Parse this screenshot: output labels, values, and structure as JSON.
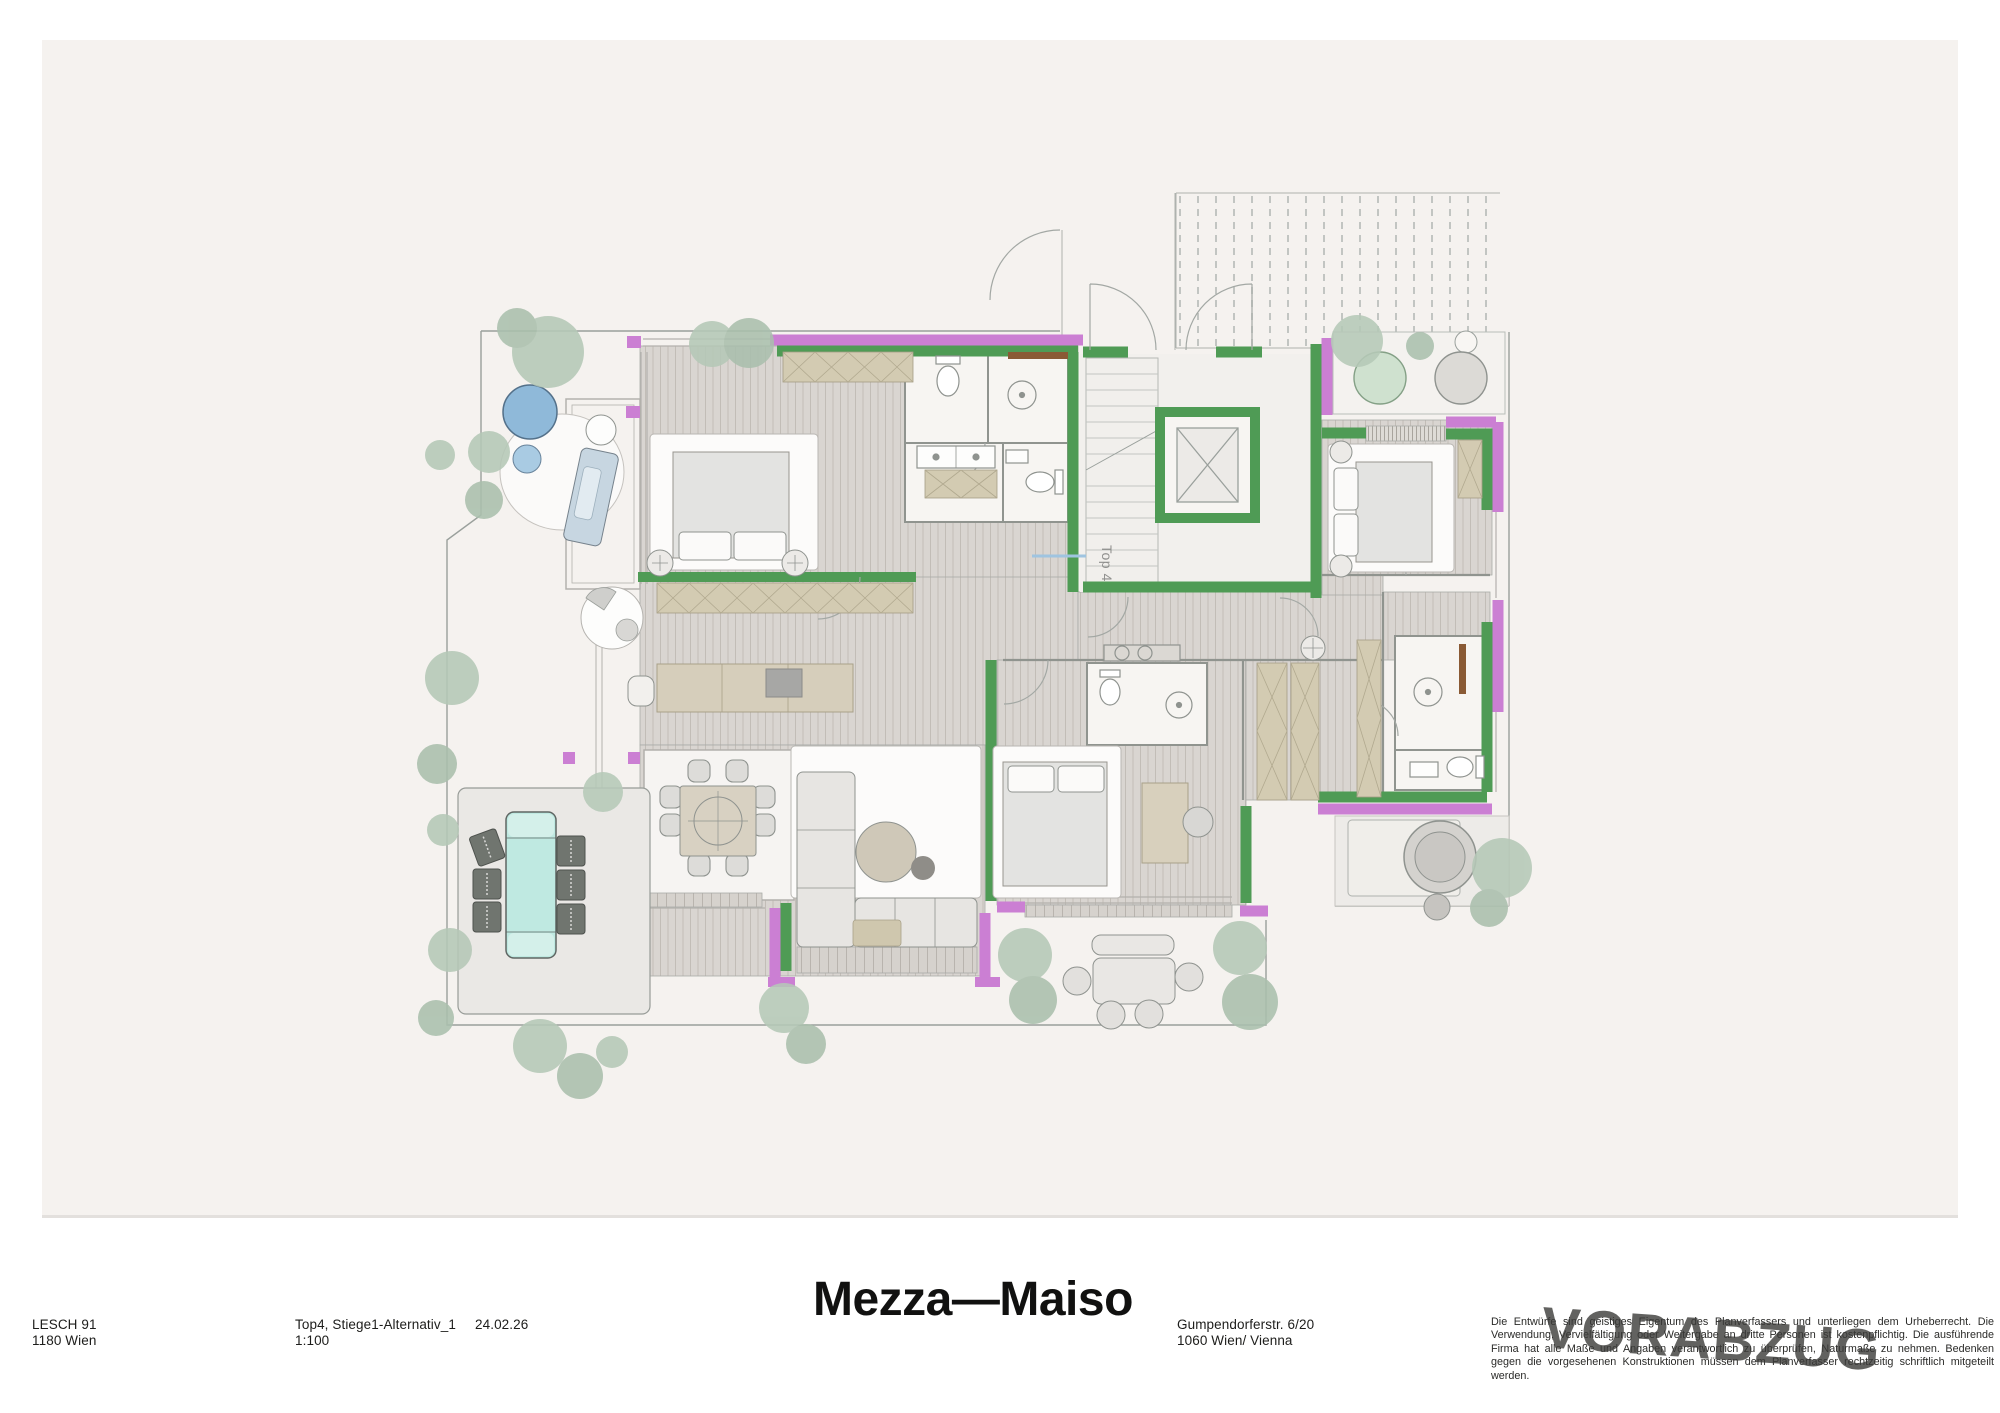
{
  "sheet": {
    "watermark": "VORABZUG",
    "paper_color": "#f5f2ef",
    "background_color": "#ffffff"
  },
  "title_block": {
    "office": {
      "line1": "LESCH 91",
      "line2": "1180 Wien"
    },
    "drawing": {
      "line1": "Top4, Stiege1-Alternativ_1",
      "line2": "1:100"
    },
    "date": "24.02.26",
    "project_title": "Mezza—Maiso",
    "address": {
      "line1": "Gumpendorferstr. 6/20",
      "line2": "1060 Wien/ Vienna"
    },
    "disclaimer": "Die Entwürfe sind geistiges Eigentum des Planverfassers und unterliegen dem Urheberrecht. Die Verwendung, Vervielfältigung oder Weitergabe an dritte Personen ist kostenpflichtig. Die ausführende Firma hat alle Maße und Angaben verantwortlich zu überprüfen, Naturmaße zu nehmen. Bedenken gegen die vorgesehenen Konstruktionen müssen dem Planverfasser rechtzeitig schriftlich mitgeteilt werden."
  },
  "plan": {
    "unit_label": "Top 4",
    "legend_colors": {
      "exterior_wall_green": "#4f9b55",
      "glazing_magenta": "#cb7fd3",
      "pool_water": "#bfe9e1",
      "vegetation": "#b5c8b7",
      "wood_floor": "#d9d5d1",
      "wardrobe_tan": "#d3cbb2"
    }
  }
}
